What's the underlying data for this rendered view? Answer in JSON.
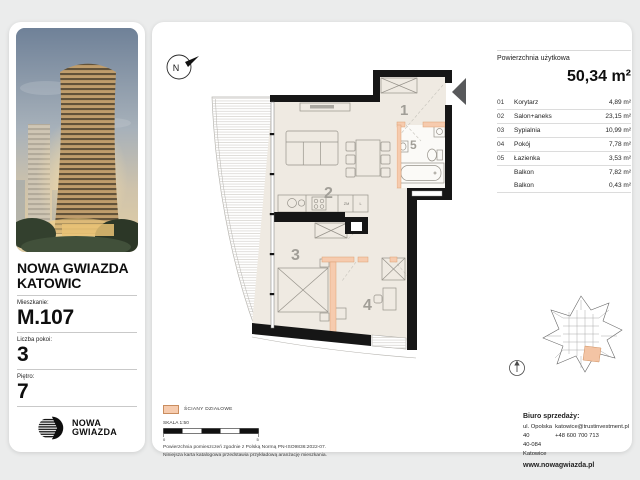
{
  "sidebar": {
    "project_title_line1": "NOWA GWIAZDA",
    "project_title_line2": "KATOWIC",
    "fields": [
      {
        "label": "Mieszkanie:",
        "value": "M.107"
      },
      {
        "label": "Liczba pokoi:",
        "value": "3"
      },
      {
        "label": "Piętro:",
        "value": "7"
      }
    ],
    "logo_line1": "NOWA",
    "logo_line2": "GWIAZDA"
  },
  "plan": {
    "north_label": "N",
    "room_numbers": [
      "1",
      "2",
      "3",
      "4",
      "5"
    ],
    "kitchen_labels": {
      "zm": "ZM",
      "l": "L"
    },
    "colors": {
      "wall": "#161616",
      "floor": "#efeae2",
      "partition_fill": "#f6cbae",
      "partition_stroke": "#dd9f72",
      "room_number": "#a19e97",
      "entrance_marker": "#58595b"
    }
  },
  "legend": {
    "partition_label": "ŚCIANY DZIAŁOWE",
    "scale_label": "SKALA 1:50",
    "scale_ticks": [
      "0",
      "5"
    ]
  },
  "disclaimer": {
    "line1": "Powierzchnia pomieszczeń zgodnie z Polską Normą PN-ISO9836:2022-07.",
    "line2": "Niniejsza karta katalogowa przedstawia przykładową aranżację mieszkania."
  },
  "summary": {
    "label": "Powierzchnia użytkowa",
    "value": "50,34 m²"
  },
  "rooms": [
    {
      "no": "01",
      "name": "Korytarz",
      "area": "4,89 m²"
    },
    {
      "no": "02",
      "name": "Salon+aneks",
      "area": "23,15 m²"
    },
    {
      "no": "03",
      "name": "Sypialnia",
      "area": "10,99 m²"
    },
    {
      "no": "04",
      "name": "Pokój",
      "area": "7,78 m²"
    },
    {
      "no": "05",
      "name": "Łazienka",
      "area": "3,53 m²"
    },
    {
      "no": "",
      "name": "Balkon",
      "area": "7,82 m²"
    },
    {
      "no": "",
      "name": "Balkon",
      "area": "0,43 m²"
    }
  ],
  "contact": {
    "heading": "Biuro sprzedaży:",
    "address_line1": "ul. Opolska 40",
    "address_line2": "40-084 Katowice",
    "email": "katowice@trustinvestment.pl",
    "phone": "+48 600 700 713",
    "website": "www.nowagwiazda.pl"
  }
}
